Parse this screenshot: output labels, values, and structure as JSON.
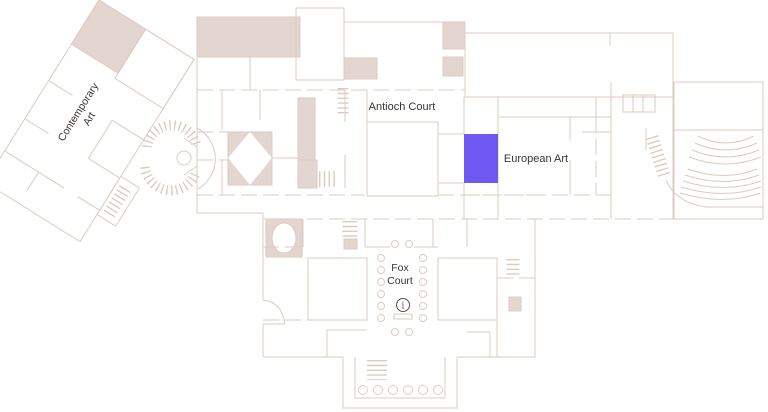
{
  "map": {
    "type": "museum-floor-plan",
    "rooms": {
      "contemporary_art": {
        "label_line1": "Contemporary",
        "label_line2": "Art"
      },
      "antioch_court": {
        "label": "Antioch Court"
      },
      "european_art": {
        "label": "European Art"
      },
      "fox_court": {
        "label_line1": "Fox",
        "label_line2": "Court"
      }
    },
    "info_marker": {
      "symbol": "i"
    },
    "colors": {
      "wall": "#ddcbc3",
      "room_fill": "#e3d5cf",
      "highlight": "#6e5af2",
      "label_text": "#3a3430",
      "background": "#ffffff"
    }
  }
}
